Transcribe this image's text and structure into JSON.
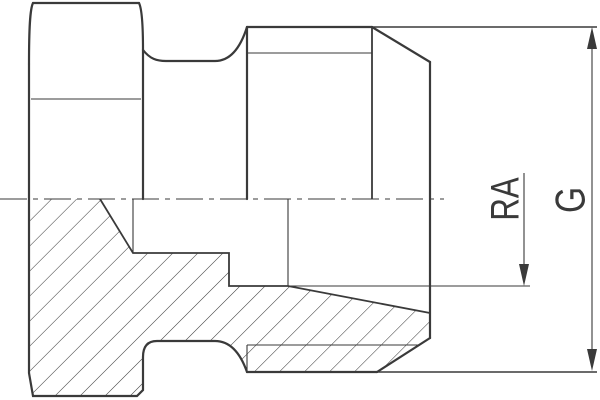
{
  "drawing": {
    "kind": "technical-section-drawing",
    "labels": {
      "ra": "RA",
      "g": "G"
    },
    "colors": {
      "line": "#3a3a3a",
      "background": "#ffffff"
    }
  }
}
